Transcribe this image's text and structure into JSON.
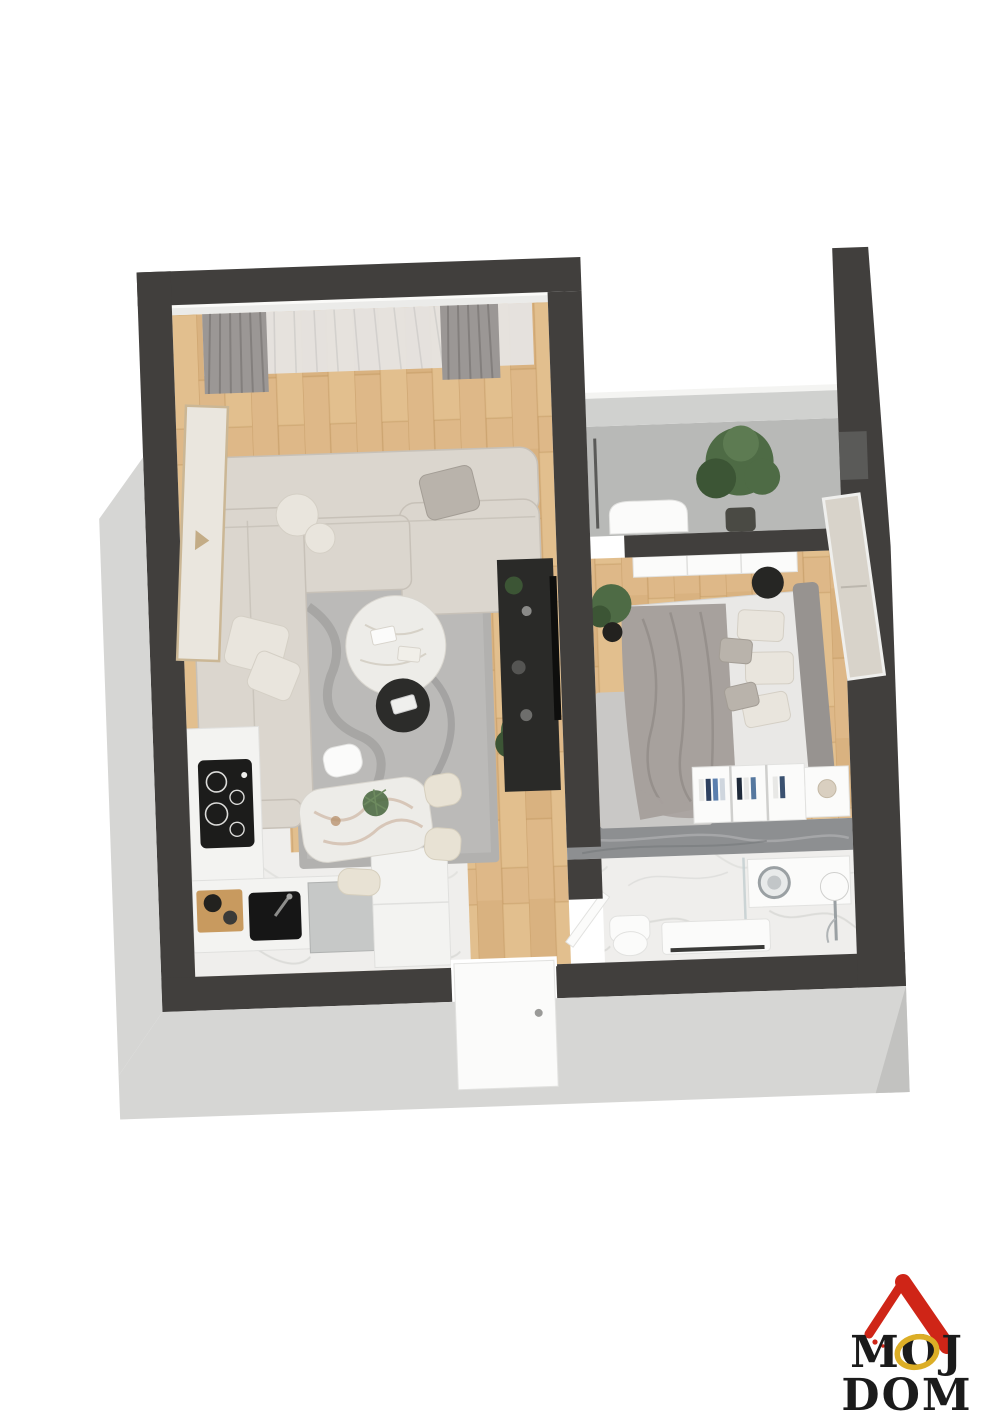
{
  "logo": {
    "line1": "MOJ",
    "line2": "DOM"
  },
  "colors": {
    "bg": "#ffffff",
    "wall_dark": "#413f3d",
    "wall_facade": "#d6d6d4",
    "wall_inner": "#d0d1cf",
    "floor_wood": "#deb888",
    "wood_line": "#c0955e",
    "floor_marble": "#efeeec",
    "floor_concrete": "#b8b9b7",
    "marble_wall": "#8d8f91",
    "rug_living": "#b2b1af",
    "rug_bedroom": "#c9c8c6",
    "sofa": "#dbd6ce",
    "sofa_shadow": "#c7c1b8",
    "pillow_gray": "#b9b3ab",
    "pillow_white": "#e9e5dd",
    "bed_sheet": "#e9e8e6",
    "bed_blanket": "#a7a19d",
    "headboard": "#979390",
    "curtain_gray": "#9b9795",
    "curtain_sheer": "#e6e4e2",
    "tv_unit": "#2a2a28",
    "counter": "#f3f3f1",
    "cooktop": "#1c1c1b",
    "appliance": "#c6c8c7",
    "plant": "#4e6b45",
    "plant_dark": "#3c5535",
    "pot_dark": "#23221f",
    "table_marble": "#edece8",
    "chair_beige": "#e8e2d4",
    "door_white": "#fbfbfa",
    "logo_red": "#cf2517",
    "logo_yellow": "#dcae26",
    "logo_text": "#1b1b1b"
  }
}
